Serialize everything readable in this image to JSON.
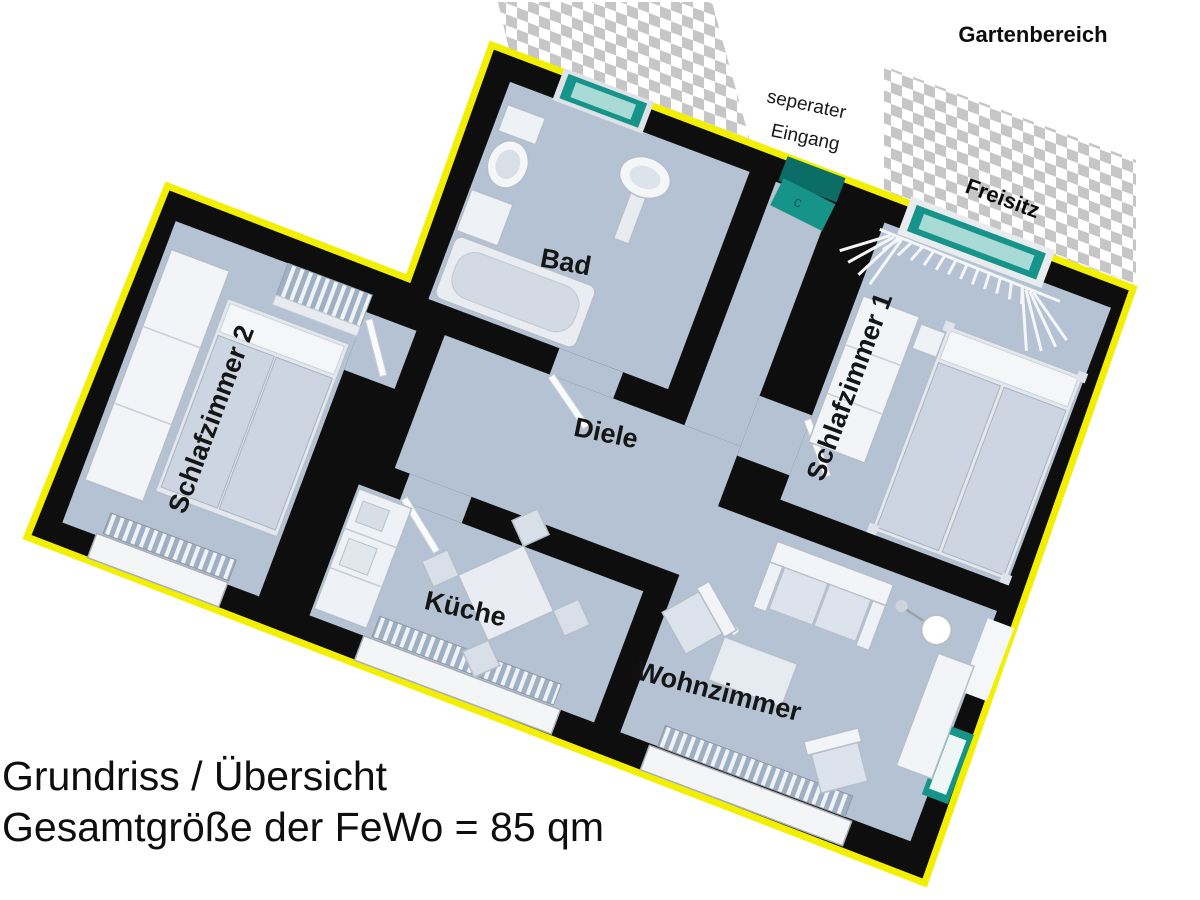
{
  "title": {
    "line1": "Grundriss / Übersicht",
    "line2": "Gesamtgröße der FeWo = 85 qm"
  },
  "outside": {
    "garden": "Gartenbereich",
    "entrance_line1": "seperater",
    "entrance_line2": "Eingang",
    "terrace": "Freisitz"
  },
  "rooms": {
    "bath": "Bad",
    "hall": "Diele",
    "kitchen": "Küche",
    "living": "Wohnzimmer",
    "bedroom1": "Schlafzimmer 1",
    "bedroom2": "Schlafzimmer 2"
  },
  "entry_door_mark": "c",
  "colors": {
    "outline": "#f2ef00",
    "walls": "#0e0e0e",
    "floor": "#b5c2d4",
    "glass": "#17948a",
    "glass_inner": "#a8dbd5",
    "checker": "#c6c6c6",
    "furniture": "#eef1f5"
  }
}
